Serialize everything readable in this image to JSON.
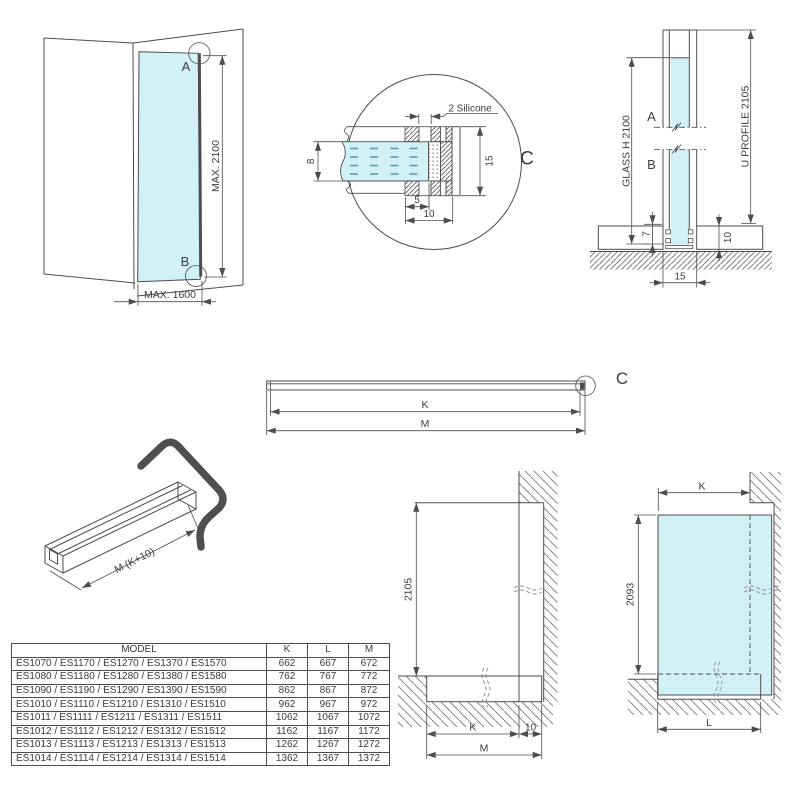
{
  "colors": {
    "glass": "#d2f1f7",
    "line": "#4d4d4d",
    "hatch": "#8a8a8a"
  },
  "perspective": {
    "point_a": "A",
    "point_b": "B",
    "max_height": "MAX. 2100",
    "max_width": "MAX. 1600"
  },
  "detail": {
    "callout": "C",
    "silicone": "2 Silicone",
    "glass_thickness": "8",
    "profile_height": "15",
    "inset": "5",
    "profile_width": "10"
  },
  "section": {
    "glass_height": "GLASS H 2100",
    "profile_length": "U PROFILE 2105",
    "point_a": "A",
    "point_b": "B",
    "insert_depth": "7",
    "base_height": "10",
    "base_width": "15"
  },
  "profile_bar": {
    "k": "K",
    "m": "M",
    "callout": "C"
  },
  "profile_3d": {
    "length": "M (K+10)"
  },
  "wall_section": {
    "height": "2105",
    "k": "K",
    "offset": "10",
    "m": "M"
  },
  "panel_view": {
    "k": "K",
    "height": "2093",
    "l": "L"
  },
  "table": {
    "headers": [
      "MODEL",
      "K",
      "L",
      "M"
    ],
    "rows": [
      {
        "model": "ES1070 / ES1170 / ES1270 / ES1370 / ES1570",
        "k": "662",
        "l": "667",
        "m": "672"
      },
      {
        "model": "ES1080 / ES1180 / ES1280 / ES1380 / ES1580",
        "k": "762",
        "l": "767",
        "m": "772"
      },
      {
        "model": "ES1090 / ES1190 / ES1290 / ES1390 / ES1590",
        "k": "862",
        "l": "867",
        "m": "872"
      },
      {
        "model": "ES1010 / ES1110 / ES1210 / ES1310 / ES1510",
        "k": "962",
        "l": "967",
        "m": "972"
      },
      {
        "model": "ES1011 / ES1111 / ES1211 / ES1311 / ES1511",
        "k": "1062",
        "l": "1067",
        "m": "1072"
      },
      {
        "model": "ES1012 / ES1112 / ES1212 / ES1312 / ES1512",
        "k": "1162",
        "l": "1167",
        "m": "1172"
      },
      {
        "model": "ES1013 / ES1113 / ES1213 / ES1313 / ES1513",
        "k": "1262",
        "l": "1267",
        "m": "1272"
      },
      {
        "model": "ES1014 / ES1114 / ES1214 / ES1314 / ES1514",
        "k": "1362",
        "l": "1367",
        "m": "1372"
      }
    ]
  }
}
